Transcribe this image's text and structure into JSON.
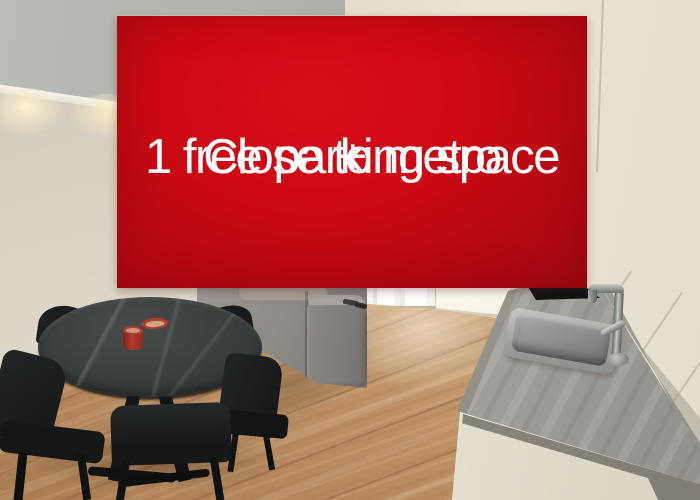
{
  "banner": {
    "lines": [
      "1 free parking space",
      "+",
      "Close to metro"
    ],
    "background_color": "#c40912",
    "text_color": "#ffffff"
  },
  "scene": {
    "subject": "apartment interior with dining table, sofa and kitchen counter",
    "palette": {
      "ceiling": "#aeb1ab",
      "walls": "#e2dccd",
      "wood_floor": "#c49a6e",
      "sofa": "#8d8a86",
      "table_top": "#3b3f3e",
      "chairs": "#1a1c1d",
      "cups": "#b53a2c",
      "countertop": "#a7a6a0",
      "cabinet": "#efeadd",
      "sink": "#9a9c99"
    }
  }
}
